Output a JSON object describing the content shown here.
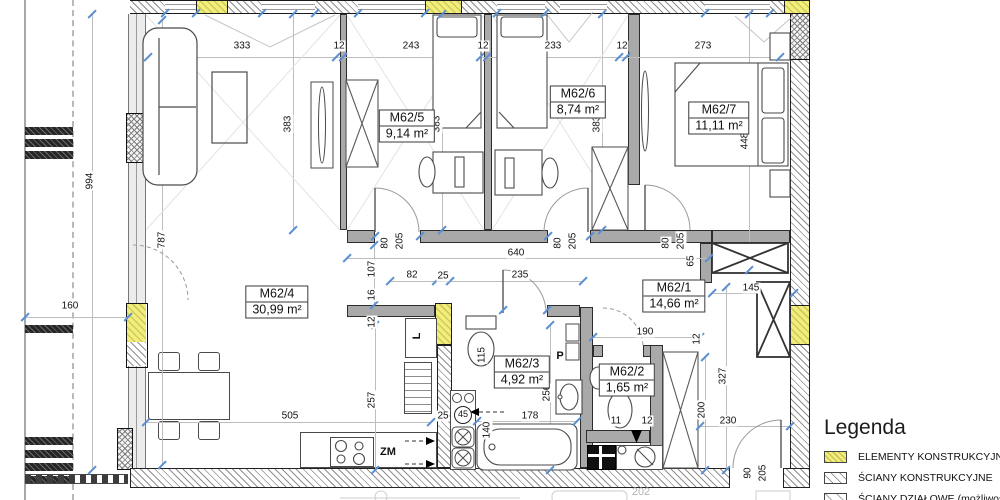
{
  "drawing": {
    "type": "apartment floor plan",
    "unit_hint": "cm"
  },
  "rooms": [
    {
      "name": "M62/1",
      "area": "14,66 m²",
      "cx": 674,
      "cy": 296
    },
    {
      "name": "M62/2",
      "area": "1,65 m²",
      "cx": 627,
      "cy": 380
    },
    {
      "name": "M62/3",
      "area": "4,92 m²",
      "cx": 522,
      "cy": 372
    },
    {
      "name": "M62/4",
      "area": "30,99 m²",
      "cx": 277,
      "cy": 302
    },
    {
      "name": "M62/5",
      "area": "9,14 m²",
      "cx": 407,
      "cy": 126
    },
    {
      "name": "M62/6",
      "area": "8,74 m²",
      "cx": 578,
      "cy": 102
    },
    {
      "name": "M62/7",
      "area": "11,11 m²",
      "cx": 719,
      "cy": 118
    }
  ],
  "dims": [
    {
      "t": "333",
      "x": 242,
      "y": 46
    },
    {
      "t": "12",
      "x": 339,
      "y": 46
    },
    {
      "t": "243",
      "x": 411,
      "y": 46
    },
    {
      "t": "12",
      "x": 483,
      "y": 46
    },
    {
      "t": "233",
      "x": 553,
      "y": 46
    },
    {
      "t": "12",
      "x": 622,
      "y": 46
    },
    {
      "t": "273",
      "x": 703,
      "y": 46
    },
    {
      "t": "994",
      "x": 90,
      "y": 181,
      "r": 1
    },
    {
      "t": "787",
      "x": 162,
      "y": 240,
      "r": 1
    },
    {
      "t": "160",
      "x": 70,
      "y": 306
    },
    {
      "t": "383",
      "x": 288,
      "y": 124,
      "r": 1
    },
    {
      "t": "383",
      "x": 437,
      "y": 124,
      "r": 1
    },
    {
      "t": "383",
      "x": 597,
      "y": 124,
      "r": 1
    },
    {
      "t": "448",
      "x": 745,
      "y": 141,
      "r": 1
    },
    {
      "t": "80",
      "x": 385,
      "y": 243,
      "r": 1
    },
    {
      "t": "205",
      "x": 400,
      "y": 241,
      "r": 1
    },
    {
      "t": "80",
      "x": 558,
      "y": 243,
      "r": 1
    },
    {
      "t": "205",
      "x": 573,
      "y": 241,
      "r": 1
    },
    {
      "t": "80",
      "x": 666,
      "y": 243,
      "r": 1
    },
    {
      "t": "205",
      "x": 681,
      "y": 241,
      "r": 1
    },
    {
      "t": "640",
      "x": 516,
      "y": 253
    },
    {
      "t": "65",
      "x": 691,
      "y": 261,
      "r": 1
    },
    {
      "t": "145",
      "x": 751,
      "y": 288
    },
    {
      "t": "107",
      "x": 372,
      "y": 269,
      "r": 1
    },
    {
      "t": "82",
      "x": 412,
      "y": 275
    },
    {
      "t": "25",
      "x": 443,
      "y": 276
    },
    {
      "t": "235",
      "x": 520,
      "y": 275
    },
    {
      "t": "16",
      "x": 372,
      "y": 295,
      "r": 1
    },
    {
      "t": "12",
      "x": 372,
      "y": 322,
      "r": 1
    },
    {
      "t": "190",
      "x": 645,
      "y": 332
    },
    {
      "t": "12",
      "x": 697,
      "y": 339,
      "r": 1
    },
    {
      "t": "327",
      "x": 723,
      "y": 376,
      "r": 1
    },
    {
      "t": "200",
      "x": 702,
      "y": 410,
      "r": 1
    },
    {
      "t": "230",
      "x": 728,
      "y": 421
    },
    {
      "t": "505",
      "x": 290,
      "y": 416
    },
    {
      "t": "257",
      "x": 372,
      "y": 400,
      "r": 1
    },
    {
      "t": "25",
      "x": 443,
      "y": 416
    },
    {
      "t": "178",
      "x": 530,
      "y": 416
    },
    {
      "t": "140",
      "x": 487,
      "y": 430,
      "r": 1
    },
    {
      "t": "256",
      "x": 547,
      "y": 393,
      "r": 1
    },
    {
      "t": "115",
      "x": 482,
      "y": 355,
      "r": 1
    },
    {
      "t": "11",
      "x": 616,
      "y": 421
    },
    {
      "t": "12",
      "x": 647,
      "y": 421
    },
    {
      "t": "90",
      "x": 748,
      "y": 473,
      "r": 1
    },
    {
      "t": "205",
      "x": 763,
      "y": 473,
      "r": 1
    },
    {
      "t": "202",
      "x": 641,
      "y": 492,
      "m": 1
    },
    {
      "t": "45",
      "x": 463,
      "y": 415,
      "c": 1
    },
    {
      "t": "P",
      "x": 560,
      "y": 356,
      "b": 1
    },
    {
      "t": "ZM",
      "x": 388,
      "y": 452,
      "b": 1
    },
    {
      "t": "L",
      "x": 417,
      "y": 336,
      "r": 1,
      "b": 1
    }
  ],
  "ticks": [
    [
      148,
      57
    ],
    [
      336,
      57
    ],
    [
      343,
      57
    ],
    [
      480,
      57
    ],
    [
      487,
      57
    ],
    [
      619,
      57
    ],
    [
      626,
      57
    ],
    [
      780,
      57
    ],
    [
      293,
      14
    ],
    [
      293,
      230
    ],
    [
      442,
      14
    ],
    [
      442,
      230
    ],
    [
      602,
      14
    ],
    [
      602,
      230
    ],
    [
      749,
      14
    ],
    [
      749,
      270
    ],
    [
      92,
      14
    ],
    [
      92,
      470
    ],
    [
      162,
      20
    ],
    [
      162,
      465
    ],
    [
      25,
      317
    ],
    [
      128,
      317
    ],
    [
      347,
      258
    ],
    [
      709,
      258
    ],
    [
      390,
      281
    ],
    [
      436,
      281
    ],
    [
      450,
      281
    ],
    [
      583,
      281
    ],
    [
      146,
      422
    ],
    [
      431,
      422
    ],
    [
      477,
      421
    ],
    [
      577,
      421
    ],
    [
      593,
      337
    ],
    [
      700,
      337
    ],
    [
      712,
      293
    ],
    [
      794,
      293
    ],
    [
      374,
      245
    ],
    [
      374,
      305
    ],
    [
      375,
      325
    ],
    [
      375,
      470
    ],
    [
      550,
      325
    ],
    [
      550,
      470
    ],
    [
      705,
      357
    ],
    [
      705,
      470
    ],
    [
      726,
      287
    ],
    [
      726,
      470
    ],
    [
      700,
      426
    ],
    [
      790,
      426
    ],
    [
      165,
      13
    ],
    [
      196,
      13
    ],
    [
      262,
      13
    ],
    [
      315,
      13
    ],
    [
      358,
      13
    ],
    [
      425,
      13
    ],
    [
      497,
      13
    ],
    [
      545,
      13
    ],
    [
      705,
      13
    ],
    [
      770,
      13
    ],
    [
      375,
      236
    ],
    [
      420,
      236
    ],
    [
      548,
      236
    ],
    [
      590,
      236
    ],
    [
      503,
      310
    ],
    [
      547,
      310
    ]
  ],
  "legend": {
    "title": "Legenda",
    "items": [
      {
        "label": "ELEMENTY KONSTRUKCYJNE",
        "swatch": "yellow"
      },
      {
        "label": "ŚCIANY KONSTRUKCYJNE",
        "swatch": "diag"
      },
      {
        "label": "ŚCIANY DZIAŁOWE (możliwość",
        "swatch": "diag2"
      }
    ]
  },
  "colors": {
    "structural_yellow": "#f2ee7c",
    "wall_gray": "#a9a9a9",
    "tick_blue": "#5b8fd0"
  }
}
